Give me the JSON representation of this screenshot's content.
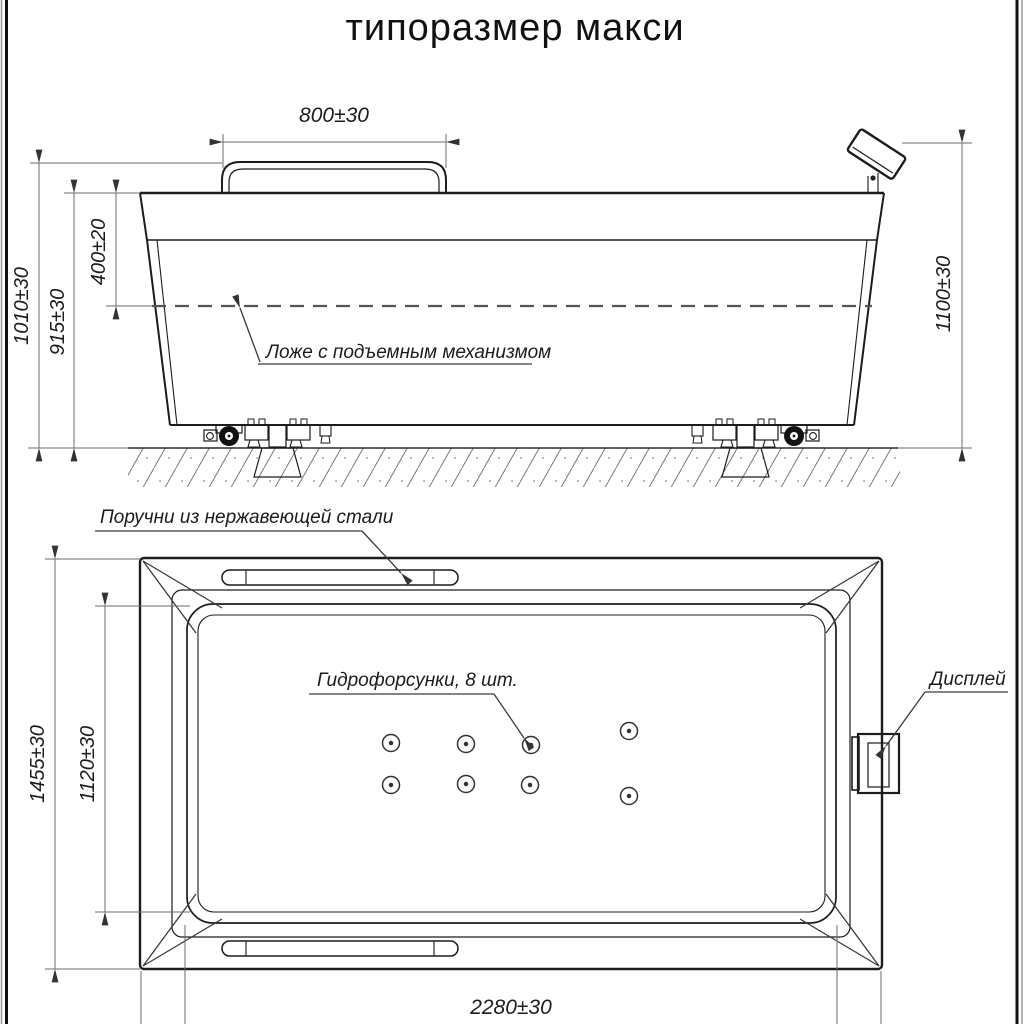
{
  "title": "типоразмер макси",
  "side_view": {
    "dim_handrail_length": "800±30",
    "dim_overall_height": "1010±30",
    "dim_rim_height": "915±30",
    "dim_bed_depth": "400±20",
    "dim_display_height": "1100±30",
    "label_bed": "Ложе с подъемным механизмом"
  },
  "top_view": {
    "label_handrails": "Поручни из нержавеющей стали",
    "label_jets": "Гидрофорсунки, 8 шт.",
    "label_display": "Дисплей",
    "dim_overall_width": "1455±30",
    "dim_inner_width": "1120±30",
    "dim_overall_length": "2280±30",
    "jets_count": 8
  },
  "colors": {
    "line": "#1c1c1c",
    "thin_line": "#6b6b6b",
    "background": "#ffffff"
  }
}
